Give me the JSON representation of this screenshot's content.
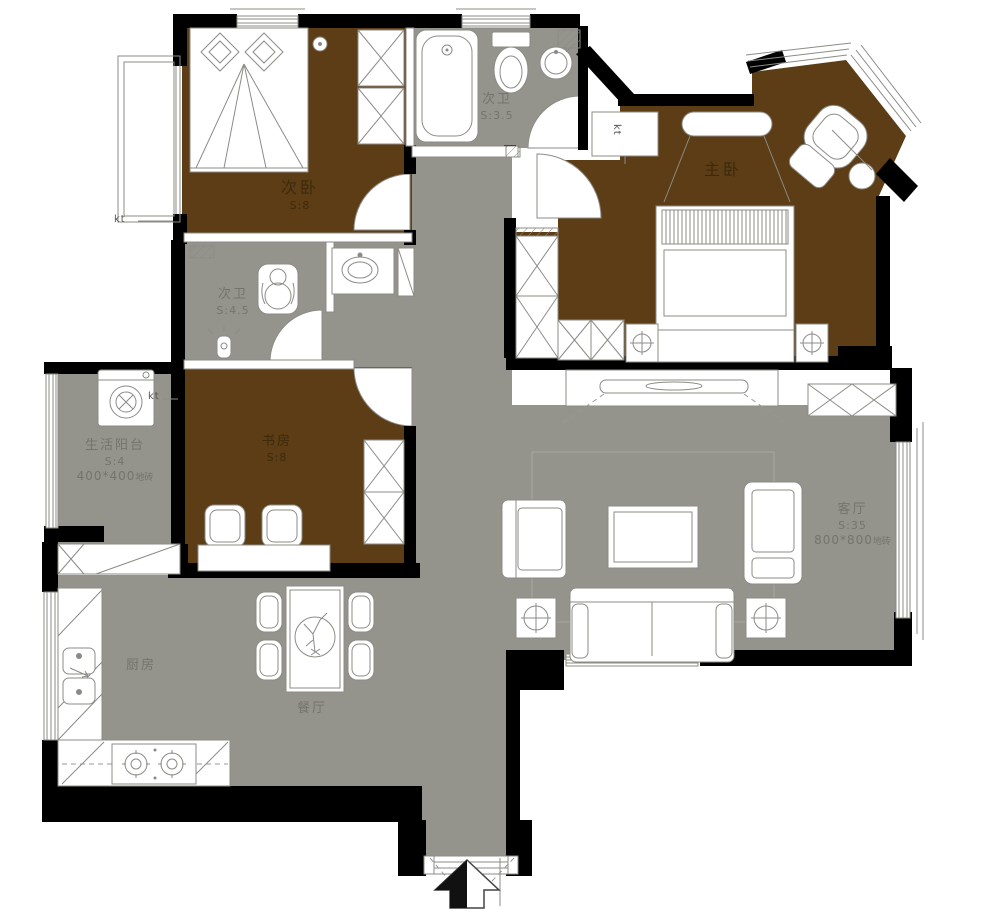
{
  "palette": {
    "room_fill_brown": "#5c3d15",
    "floor_fill_gray": "#94938c",
    "wall_color": "#000000",
    "furniture_line": "#8b8b86",
    "label_on_brown": "#3d2a0c",
    "label_on_gray": "#75746c"
  },
  "rooms": [
    {
      "id": "second-bedroom",
      "name": "次卧",
      "area": "S:8"
    },
    {
      "id": "second-bath-upper",
      "name": "次卫",
      "area": "S:3.5"
    },
    {
      "id": "master-bedroom",
      "name": "主卧",
      "area": ""
    },
    {
      "id": "second-bath-lower",
      "name": "次卫",
      "area": "S:4.5"
    },
    {
      "id": "service-balcony",
      "name": "生活阳台",
      "area": "S:4",
      "finish": "400*400",
      "finish_suffix": "地砖"
    },
    {
      "id": "study",
      "name": "书房",
      "area": "S:8"
    },
    {
      "id": "living-room",
      "name": "客厅",
      "area": "S:35",
      "finish": "800*800",
      "finish_suffix": "地砖"
    },
    {
      "id": "kitchen",
      "name": "厨房",
      "area": ""
    },
    {
      "id": "dining-room",
      "name": "餐厅",
      "area": ""
    }
  ],
  "annotations": {
    "ac": "kt"
  }
}
